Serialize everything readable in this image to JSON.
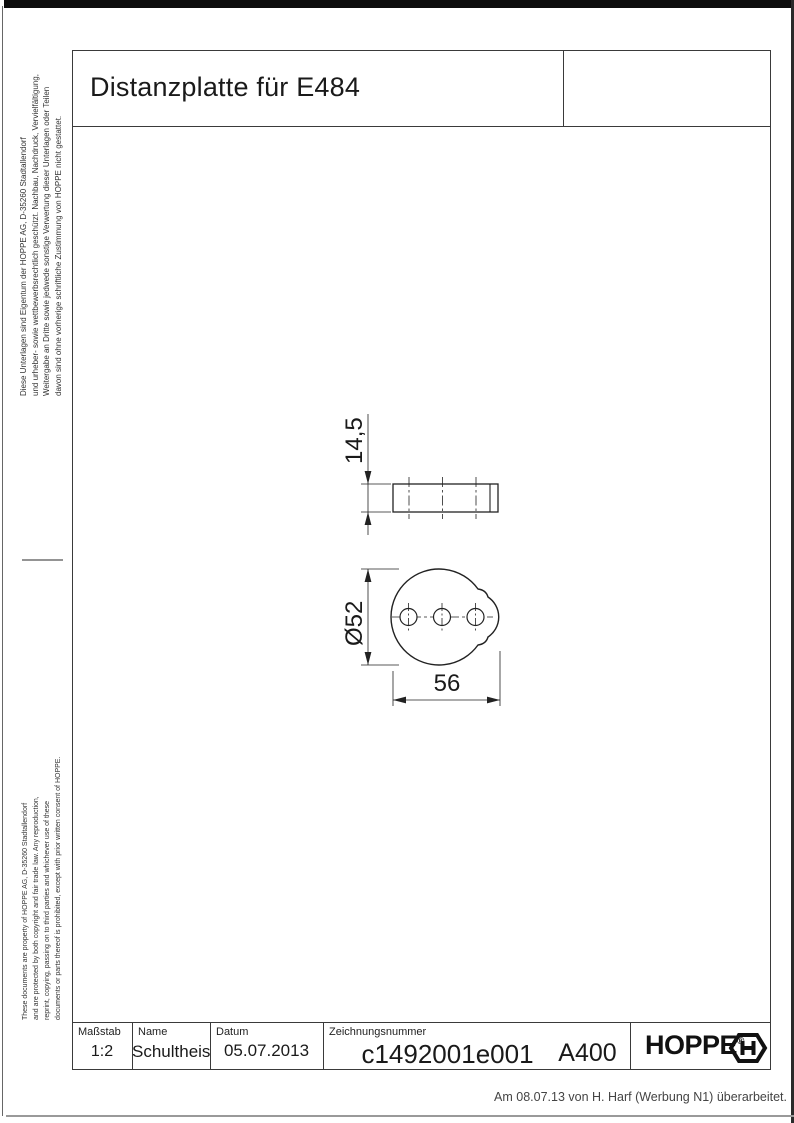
{
  "page": {
    "title": "Distanzplatte für E484",
    "revision_note": "Am 08.07.13 von H. Harf (Werbung N1) überarbeitet."
  },
  "side_notes": {
    "german": [
      "Diese Unterlagen sind Eigentum der  HOPPE AG, D-35260 Stadtallendorf",
      "und urheber- sowie wettbewerbsrechtlich geschützt. Nachbau, Nachdruck, Vervielfältigung,",
      "Weitergabe an Dritte sowie jedwede sonstige Verwertung dieser Unterlagen oder Teilen",
      "davon sind ohne vorherige schriftliche Zustimmung von HOPPE nicht gestattet."
    ],
    "english": [
      "These documents are property of  HOPPE AG, D-35260 Stadtallendorf",
      "and are protected by both copyright and fair trade law. Any reproduction,",
      "reprint, copying, passing on to third parties and whichever use of these",
      "documents or parts thereof is prohibited, except with prior written consent of  HOPPE."
    ]
  },
  "drawing": {
    "dim_thickness": "14,5",
    "dim_diameter": "Ø52",
    "dim_width": "56"
  },
  "title_block": {
    "scale_label": "Maßstab",
    "scale_value": "1:2",
    "name_label": "Name",
    "name_value": "Schultheis",
    "date_label": "Datum",
    "date_value": "05.07.2013",
    "drawing_number_label": "Zeichnungsnummer",
    "drawing_number_value": "c1492001e001",
    "format_value": "A400",
    "logo_text": "HOPPE",
    "logo_reg": "®"
  }
}
